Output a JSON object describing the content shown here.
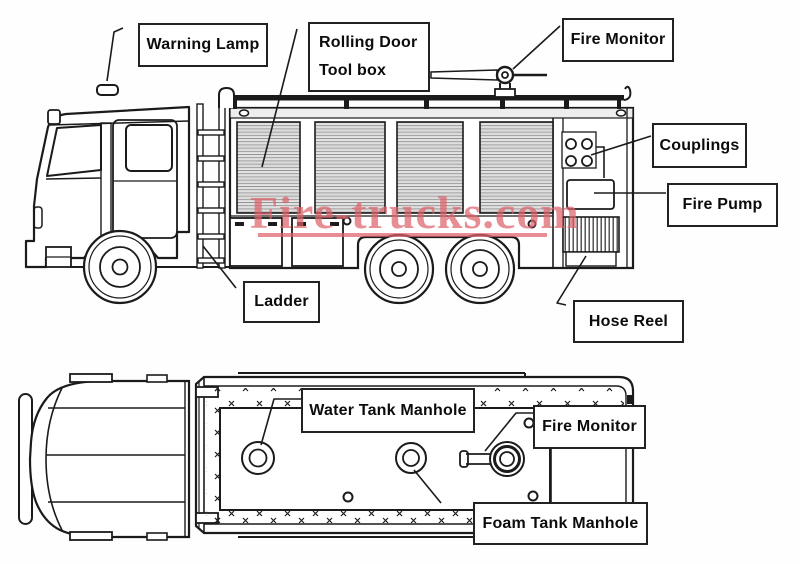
{
  "diagram_title": "Fire truck parts diagram (side view and top view)",
  "line_color": "#1b1b1b",
  "watermark": {
    "text": "Fire-trucks.com",
    "color": "#dd636b"
  },
  "side_view": {
    "labels": {
      "warning_lamp": "Warning Lamp",
      "rolling_door": "Rolling Door",
      "tool_box": "Tool box",
      "fire_monitor": "Fire Monitor",
      "couplings": "Couplings",
      "fire_pump": "Fire Pump",
      "ladder": "Ladder",
      "hose_reel": "Hose Reel"
    }
  },
  "top_view": {
    "labels": {
      "water_tank_manhole": "Water Tank Manhole",
      "fire_monitor": "Fire Monitor",
      "foam_tank_manhole": "Foam Tank Manhole"
    }
  }
}
